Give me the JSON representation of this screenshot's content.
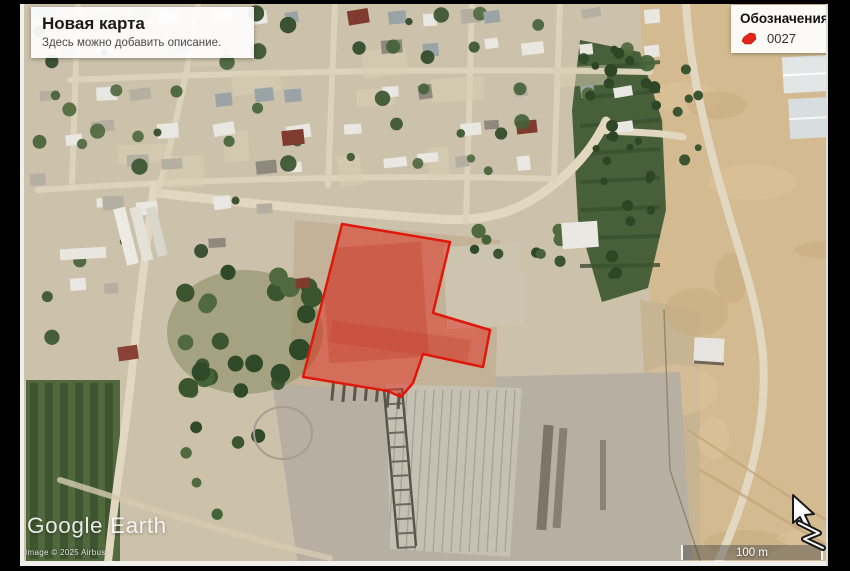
{
  "title_card": {
    "title": "Новая карта",
    "subtitle": "Здесь можно добавить описание."
  },
  "legend": {
    "title": "Обозначения",
    "items": [
      {
        "id": "0027",
        "color": "#e3261a"
      }
    ]
  },
  "overlay": {
    "label": "0027",
    "points": "342,224 450,242 433,313 490,330 483,367 423,354 413,383 401,397 388,391 303,377",
    "fill": "rgba(228,36,22,0.48)",
    "stroke": "#e0180c"
  },
  "attribution": {
    "logo": "Google Earth",
    "copyright": "Image © 2025 Airbus"
  },
  "scale_bar": {
    "label": "100 m"
  }
}
